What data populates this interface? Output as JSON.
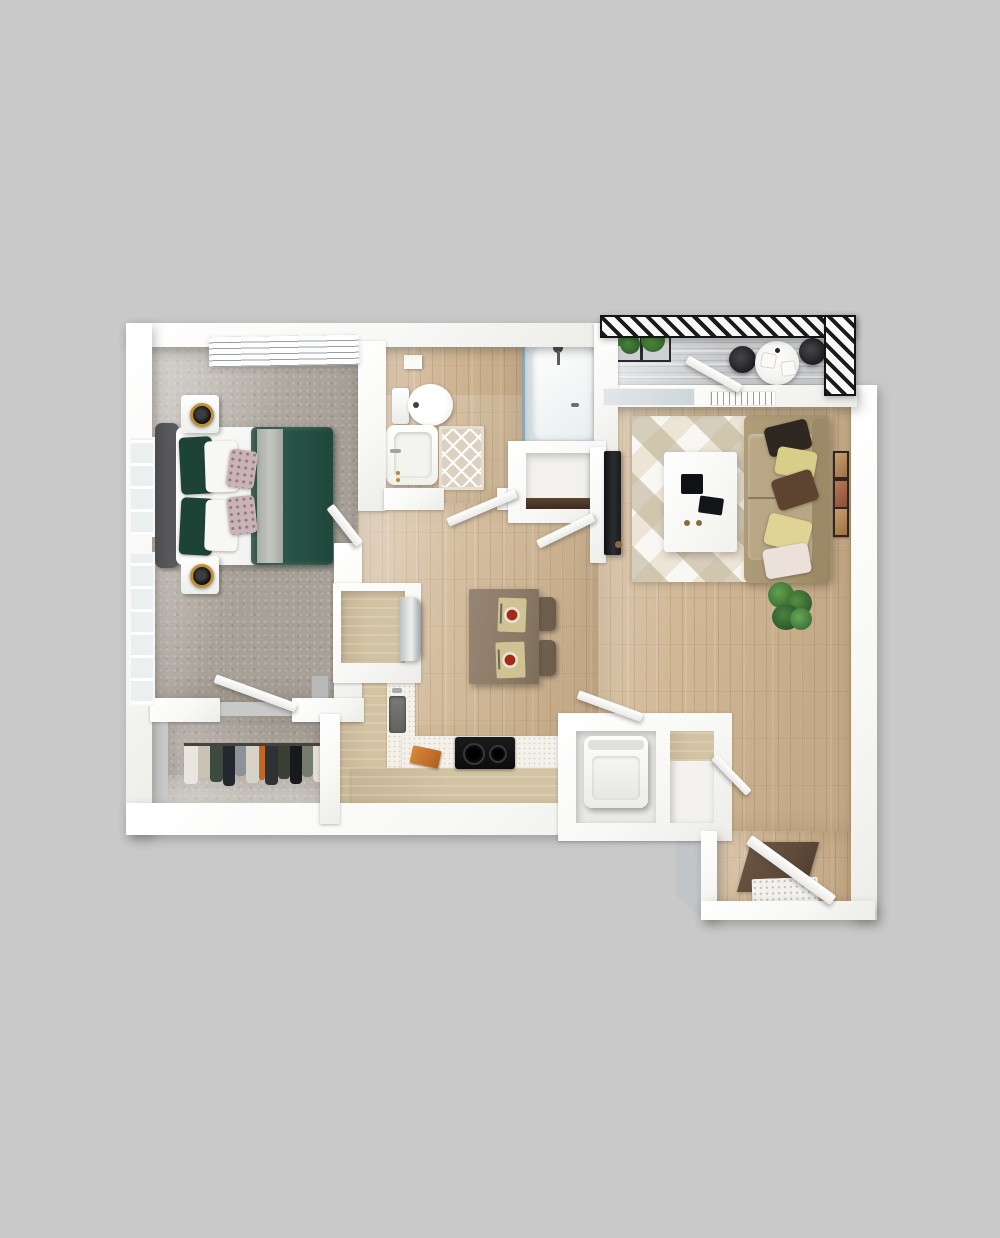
{
  "scene": {
    "type": "3d-floor-plan-render",
    "view": "top-down",
    "layout": "one-bedroom apartment with balcony",
    "visible_text": ""
  },
  "palette": {
    "bg": "#c9c9c9",
    "wall": "#fafafa",
    "wood": "#d0b795",
    "carpet": "#a8a198",
    "balcony": "#c6c8ca",
    "tan": "#d2c3a3",
    "counter": "#f4f1ea",
    "rug": "#ece5d6",
    "sofa": "#a89672",
    "cushion": "#b8a685",
    "duvet": "#2b564a",
    "pillowGreen": "#1d4336",
    "headboard": "#5d5f63",
    "gold": "#c09038",
    "tv": "#1a1c1e",
    "glass": "#cdd9df",
    "tableBrown": "#8b7b67",
    "chairBrown": "#6b5a49",
    "bathMat": "#dcd1c0",
    "entryMat": "#5f4b3a",
    "plant": "#3f7d3a",
    "rail": "#141414"
  },
  "rooms": {
    "bedroom": {
      "label": "Bedroom"
    },
    "closet": {
      "label": "Walk-in Closet"
    },
    "bathroom": {
      "label": "Bathroom"
    },
    "hallway": {
      "label": "Hallway"
    },
    "kitchen": {
      "label": "Kitchen"
    },
    "living": {
      "label": "Living Room"
    },
    "balcony": {
      "label": "Balcony"
    },
    "laundry": {
      "label": "Laundry Closet"
    },
    "storage": {
      "label": "Storage Closet"
    },
    "pantry": {
      "label": "Pantry Nook"
    },
    "entry": {
      "label": "Entry"
    }
  },
  "furniture": {
    "bedroom": [
      "bed with green duvet",
      "gray headboard",
      "two nightstands",
      "two gold ring lamps",
      "left wall windows",
      "top wall window",
      "wall panel"
    ],
    "closet": [
      "hanging clothes rod",
      "clothes"
    ],
    "bathroom": [
      "toilet",
      "vanity sink",
      "glass shower",
      "diamond bath mat",
      "towel bar",
      "wall cabinet"
    ],
    "kitchen": [
      "L-shaped counter",
      "sink with faucet",
      "two-burner cooktop",
      "cutting board",
      "refrigerator",
      "dining island table",
      "two brown chairs",
      "two place settings with red plates"
    ],
    "living": [
      "geometric rug",
      "white coffee table",
      "tablet and remote",
      "tan sofa",
      "five throw pillows",
      "tv on console",
      "three wall frames",
      "potted plant",
      "air vent",
      "sliding glass door"
    ],
    "balcony": [
      "hatched railing",
      "two planter boxes",
      "round cafe table",
      "two black chairs",
      "two place mats"
    ],
    "laundry": [
      "top-load washer",
      "louvered door"
    ],
    "entry": [
      "entry door",
      "dark door mat",
      "white threshold mat"
    ]
  }
}
